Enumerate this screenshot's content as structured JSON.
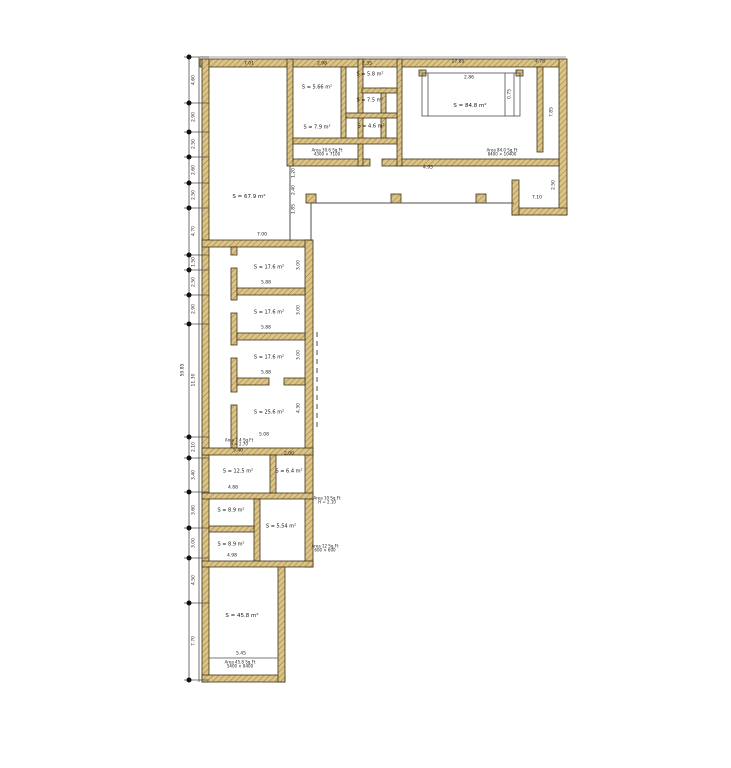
{
  "title": "Floor plan drawing",
  "colors": {
    "wall_fill": "#dcc488",
    "wall_hatch": "#9a7f45",
    "wall_outline": "#3f3213",
    "line": "#4d4d4d",
    "text": "#161616"
  },
  "rooms": [
    {
      "label": "S = 67.9 m²"
    },
    {
      "label": "S = 5.66 m²"
    },
    {
      "label": "S = 7.9 m²"
    },
    {
      "label": "S = 5.8 m²"
    },
    {
      "label": "S = 7.5 m²"
    },
    {
      "label": "S = 4.6 m²"
    },
    {
      "label": "S = 84.8 m²"
    },
    {
      "label": "S = 17.6 m²"
    },
    {
      "label": "S = 17.6 m²"
    },
    {
      "label": "S = 17.6 m²"
    },
    {
      "label": "S = 25.6 m²"
    },
    {
      "label": "S = 12.5 m²"
    },
    {
      "label": "S = 6.4 m²"
    },
    {
      "label": "S = 8.9 m²"
    },
    {
      "label": "S = 5.54 m²"
    },
    {
      "label": "S = 8.9 m²"
    },
    {
      "label": "S = 45.8 m²"
    }
  ],
  "area_notes": [
    {
      "line1": "Area 30.6 Sq.Ft",
      "line2": "4300 × 7100"
    },
    {
      "line1": "Area 84.0 Sq.Ft",
      "line2": "8400 × 10400"
    },
    {
      "line1": "Area 7.4 Sq.Ft",
      "line2": "H = 2.70"
    },
    {
      "line1": "Area 10 Sq.Ft",
      "line2": "H = 2.10"
    },
    {
      "line1": "Area 12 Sq.Ft",
      "line2": "600 × 600"
    },
    {
      "line1": "Area 45.8 Sq.Ft",
      "line2": "5400 × 8400"
    }
  ],
  "dims": {
    "top": [
      "7.01",
      "2.98",
      "2.35",
      "17.85",
      "4.78"
    ],
    "left": [
      "4.60",
      "2.90",
      "2.50",
      "2.60",
      "2.50",
      "4.70",
      "1.50",
      "2.50",
      "2.90",
      "11.30",
      "2.10",
      "3.40",
      "3.60",
      "3.00",
      "4.50",
      "7.70"
    ],
    "overall": "59.85",
    "inner": [
      "2.86",
      "0.75",
      "4.95",
      "7.10",
      "7.85",
      "2.50",
      "1.20",
      "2.40",
      "1.85",
      "7.00",
      "5.88",
      "5.88",
      "5.88",
      "5.08",
      "3.00",
      "3.00",
      "3.00",
      "4.30",
      "5.40",
      "2.00",
      "4.88",
      "4.98",
      "5.45"
    ]
  }
}
